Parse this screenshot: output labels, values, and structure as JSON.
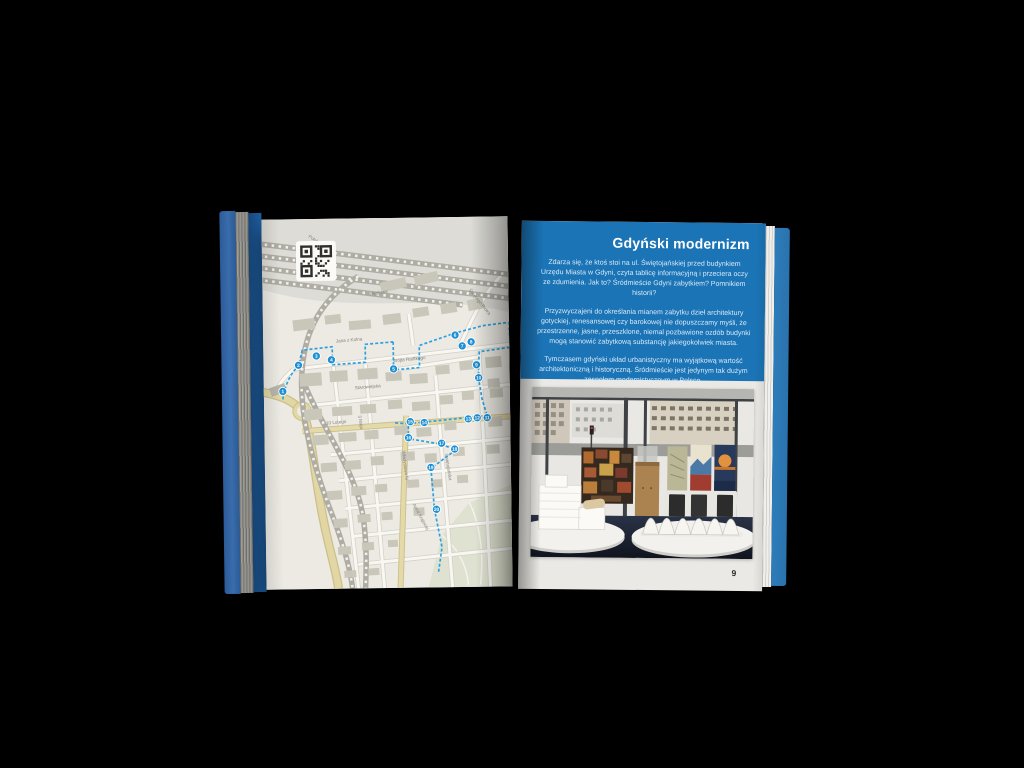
{
  "canvas": {
    "background": "#000000"
  },
  "book": {
    "colors": {
      "page_blue": "#1b74b6",
      "route_blue": "#2da1e0",
      "marker_blue": "#1d8fd2",
      "cover_blue": "#3a6cab",
      "edge_blue": "#2d7dbb",
      "map_background": "#eceae3"
    },
    "left_page": {
      "qr_icon": "qr-code",
      "street_labels": [
        {
          "text": "Polska",
          "x": 52,
          "y": 22,
          "r": 35
        },
        {
          "text": "Węglowa",
          "x": 116,
          "y": 76,
          "r": -8
        },
        {
          "text": "Jana z Kolna",
          "x": 86,
          "y": 123,
          "r": -4
        },
        {
          "text": "Świętego Piotra",
          "x": 216,
          "y": 86,
          "r": 52
        },
        {
          "text": "Wójta Radtkego",
          "x": 146,
          "y": 143,
          "r": -5
        },
        {
          "text": "Starowiejska",
          "x": 104,
          "y": 170,
          "r": -4
        },
        {
          "text": "10 Lutego",
          "x": 72,
          "y": 205,
          "r": -4
        },
        {
          "text": "3 Maja",
          "x": 95,
          "y": 204,
          "r": 82
        },
        {
          "text": "Władysława IV",
          "x": 139,
          "y": 248,
          "r": 84
        },
        {
          "text": "Świętojańska",
          "x": 182,
          "y": 250,
          "r": 82
        },
        {
          "text": "Armii Krajowej",
          "x": 154,
          "y": 300,
          "r": 62
        }
      ],
      "route": {
        "color": "#2da1e0",
        "paths": [
          "M19,180 C20,170 26,154 35,147 L39,131 L69,128 L69,146 L102,144 L102,126 L130,124",
          "M130,124 L130,152 L156,150 L156,128 L192,116 L220,109 L246,106",
          "M246,106 L247,131 L216,135 L215,148 L215,162 L218,182 L223,199",
          "M223,199 L144,206 L144,221 L177,227 L191,233 L166,251 L169,292 L176,330 L172,356",
          "M144,206 L130,205"
        ]
      },
      "markers": [
        {
          "n": 1,
          "x": 19,
          "y": 172
        },
        {
          "n": 2,
          "x": 35,
          "y": 146
        },
        {
          "n": 3,
          "x": 53,
          "y": 137
        },
        {
          "n": 4,
          "x": 68,
          "y": 141
        },
        {
          "n": 5,
          "x": 130,
          "y": 151
        },
        {
          "n": 6,
          "x": 192,
          "y": 118
        },
        {
          "n": 7,
          "x": 199,
          "y": 129
        },
        {
          "n": 8,
          "x": 208,
          "y": 125
        },
        {
          "n": 9,
          "x": 213,
          "y": 148
        },
        {
          "n": 10,
          "x": 215,
          "y": 161
        },
        {
          "n": 11,
          "x": 223,
          "y": 201
        },
        {
          "n": 12,
          "x": 213,
          "y": 201
        },
        {
          "n": 13,
          "x": 204,
          "y": 202
        },
        {
          "n": 14,
          "x": 160,
          "y": 205
        },
        {
          "n": 15,
          "x": 146,
          "y": 204
        },
        {
          "n": 16,
          "x": 144,
          "y": 220
        },
        {
          "n": 17,
          "x": 177,
          "y": 226
        },
        {
          "n": 18,
          "x": 190,
          "y": 232
        },
        {
          "n": 19,
          "x": 166,
          "y": 250
        },
        {
          "n": 20,
          "x": 171,
          "y": 292
        }
      ]
    },
    "right_page": {
      "title": "Gdyński modernizm",
      "paragraphs": [
        "Zdarza się, że ktoś stoi na ul. Świętojańskiej przed budynkiem Urzędu Miasta w Gdyni, czyta tablicę informacyjną i przeciera oczy ze zdumienia. Jak to? Śródmieście Gdyni zabytkiem? Pomnikiem historii?",
        "Przyzwyczajeni do określania mianem zabytku dzieł architektury gotyckiej, renesansowej czy barokowej nie dopuszczamy myśli, że przestrzenne, jasne, przeszklone, niemal pozbawione ozdób budynki mogą stanowić zabytkową substancję jakiegokolwiek miasta.",
        "Tymczasem gdyński układ urbanistyczny ma wyjątkową wartość architektoniczną i historyczną. Śródmieście jest jedynym tak dużym zespołem modernistycznym w Polsce."
      ],
      "page_number": "9"
    }
  }
}
